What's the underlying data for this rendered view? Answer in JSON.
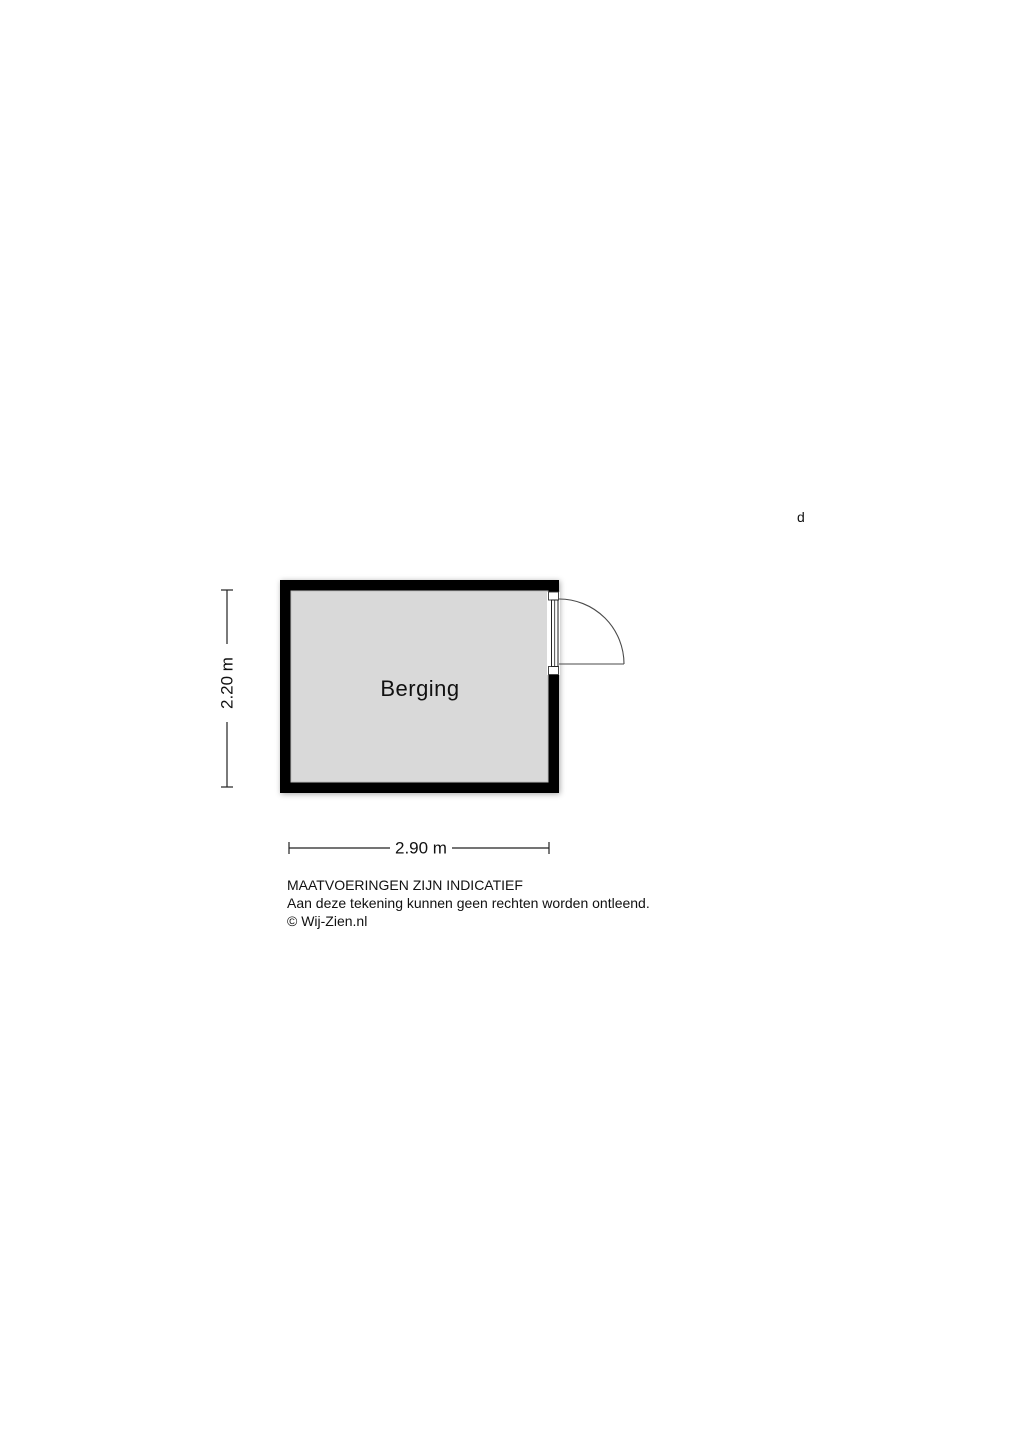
{
  "plan": {
    "room": {
      "label": "Berging"
    },
    "dimensions": {
      "height_label": "2.20 m",
      "width_label": "2.90 m"
    },
    "annotation": "d",
    "colors": {
      "wall": "#000000",
      "floor": "#d9d9d9",
      "background": "#ffffff"
    }
  },
  "footer": {
    "line1": "MAATVOERINGEN ZIJN INDICATIEF",
    "line2": "Aan deze tekening kunnen geen rechten worden ontleend.",
    "line3": "© Wij-Zien.nl"
  }
}
